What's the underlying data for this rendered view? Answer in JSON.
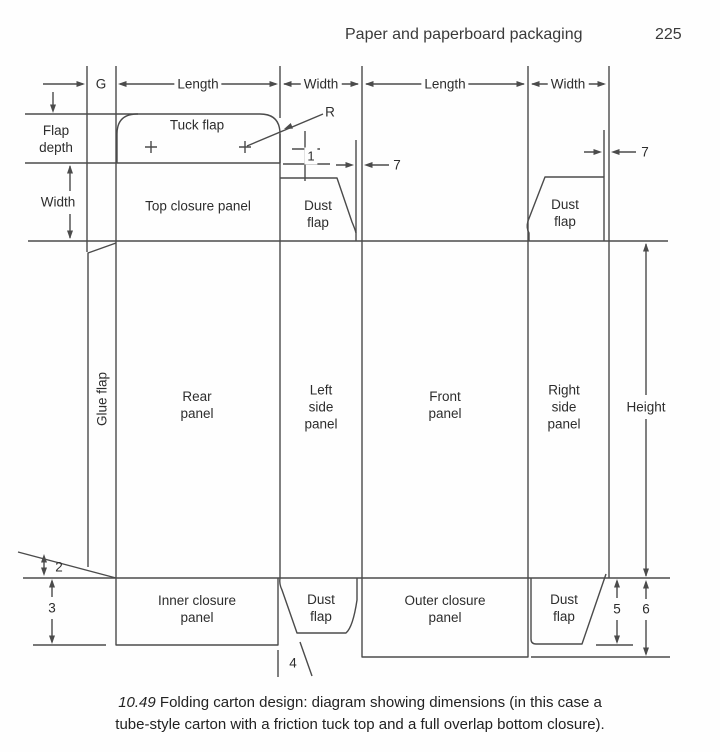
{
  "header": {
    "title": "Paper and paperboard packaging",
    "page_number": "225"
  },
  "dimension_row": {
    "g": "G",
    "length_rear": "Length",
    "width_left": "Width",
    "length_front": "Length",
    "width_right": "Width"
  },
  "side_labels": {
    "flap_depth": [
      "Flap",
      "depth"
    ],
    "width": "Width",
    "height": "Height"
  },
  "panels": {
    "tuck_flap": "Tuck flap",
    "top_closure_panel": "Top closure panel",
    "dust_flap_top_left": [
      "Dust",
      "flap"
    ],
    "dust_flap_top_right": [
      "Dust",
      "flap"
    ],
    "glue_flap": "Glue flap",
    "rear_panel": [
      "Rear",
      "panel"
    ],
    "left_side_panel": [
      "Left",
      "side",
      "panel"
    ],
    "front_panel": [
      "Front",
      "panel"
    ],
    "right_side_panel": [
      "Right",
      "side",
      "panel"
    ],
    "inner_closure_panel": [
      "Inner closure",
      "panel"
    ],
    "dust_flap_bottom_left": [
      "Dust",
      "flap"
    ],
    "outer_closure_panel": [
      "Outer closure",
      "panel"
    ],
    "dust_flap_bottom_right": [
      "Dust",
      "flap"
    ]
  },
  "annotations": {
    "radius": "R",
    "n1": "1",
    "n2": "2",
    "n3": "3",
    "n4": "4",
    "n5": "5",
    "n6": "6",
    "n7_left": "7",
    "n7_right": "7"
  },
  "caption": {
    "figure_number": "10.49",
    "line1": " Folding carton design: diagram showing dimensions (in this case a",
    "line2": "tube-style carton with a friction tuck top and a full overlap bottom closure)."
  },
  "colors": {
    "line": "#4b4b4b",
    "text": "#2d2d2d"
  }
}
